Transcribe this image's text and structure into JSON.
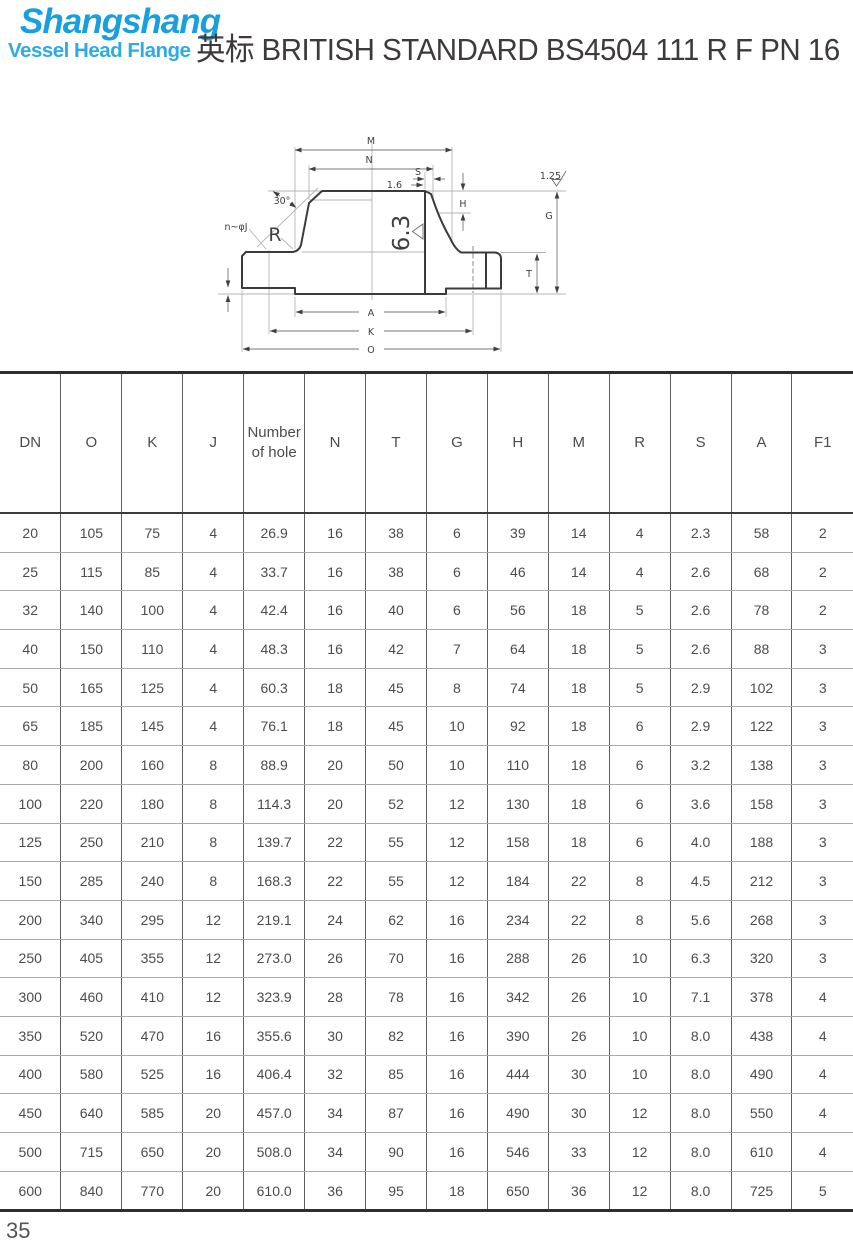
{
  "header": {
    "logo_line1": "Shangshang",
    "logo_line2": "Vessel Head Flange",
    "title_cn": "英标",
    "title_en": "BRITISH STANDARD BS4504 111 R F PN 16",
    "colors": {
      "logo_primary": "#189fe0",
      "logo_secondary": "#2fabe3",
      "title_text": "#3d3a39"
    }
  },
  "drawing": {
    "description": "Weld-neck flange cross-section with dimension callouts",
    "labels": {
      "m": "M",
      "n": "N",
      "s": "S",
      "surface_1_6": "1.6",
      "h": "H",
      "g": "G",
      "t": "T",
      "a": "A",
      "k": "K",
      "o": "O",
      "r": "R",
      "angle_30": "30°",
      "bolt_holes": "n~φJ",
      "surface_6_3": "6.3",
      "surface_1_25": "1.25"
    }
  },
  "table": {
    "columns": [
      "DN",
      "O",
      "K",
      "J",
      "Number of hole",
      "N",
      "T",
      "G",
      "H",
      "M",
      "R",
      "S",
      "A",
      "F1"
    ],
    "rows": [
      [
        "20",
        "105",
        "75",
        "4",
        "26.9",
        "16",
        "38",
        "6",
        "39",
        "14",
        "4",
        "2.3",
        "58",
        "2"
      ],
      [
        "25",
        "115",
        "85",
        "4",
        "33.7",
        "16",
        "38",
        "6",
        "46",
        "14",
        "4",
        "2.6",
        "68",
        "2"
      ],
      [
        "32",
        "140",
        "100",
        "4",
        "42.4",
        "16",
        "40",
        "6",
        "56",
        "18",
        "5",
        "2.6",
        "78",
        "2"
      ],
      [
        "40",
        "150",
        "110",
        "4",
        "48.3",
        "16",
        "42",
        "7",
        "64",
        "18",
        "5",
        "2.6",
        "88",
        "3"
      ],
      [
        "50",
        "165",
        "125",
        "4",
        "60.3",
        "18",
        "45",
        "8",
        "74",
        "18",
        "5",
        "2.9",
        "102",
        "3"
      ],
      [
        "65",
        "185",
        "145",
        "4",
        "76.1",
        "18",
        "45",
        "10",
        "92",
        "18",
        "6",
        "2.9",
        "122",
        "3"
      ],
      [
        "80",
        "200",
        "160",
        "8",
        "88.9",
        "20",
        "50",
        "10",
        "110",
        "18",
        "6",
        "3.2",
        "138",
        "3"
      ],
      [
        "100",
        "220",
        "180",
        "8",
        "114.3",
        "20",
        "52",
        "12",
        "130",
        "18",
        "6",
        "3.6",
        "158",
        "3"
      ],
      [
        "125",
        "250",
        "210",
        "8",
        "139.7",
        "22",
        "55",
        "12",
        "158",
        "18",
        "6",
        "4.0",
        "188",
        "3"
      ],
      [
        "150",
        "285",
        "240",
        "8",
        "168.3",
        "22",
        "55",
        "12",
        "184",
        "22",
        "8",
        "4.5",
        "212",
        "3"
      ],
      [
        "200",
        "340",
        "295",
        "12",
        "219.1",
        "24",
        "62",
        "16",
        "234",
        "22",
        "8",
        "5.6",
        "268",
        "3"
      ],
      [
        "250",
        "405",
        "355",
        "12",
        "273.0",
        "26",
        "70",
        "16",
        "288",
        "26",
        "10",
        "6.3",
        "320",
        "3"
      ],
      [
        "300",
        "460",
        "410",
        "12",
        "323.9",
        "28",
        "78",
        "16",
        "342",
        "26",
        "10",
        "7.1",
        "378",
        "4"
      ],
      [
        "350",
        "520",
        "470",
        "16",
        "355.6",
        "30",
        "82",
        "16",
        "390",
        "26",
        "10",
        "8.0",
        "438",
        "4"
      ],
      [
        "400",
        "580",
        "525",
        "16",
        "406.4",
        "32",
        "85",
        "16",
        "444",
        "30",
        "10",
        "8.0",
        "490",
        "4"
      ],
      [
        "450",
        "640",
        "585",
        "20",
        "457.0",
        "34",
        "87",
        "16",
        "490",
        "30",
        "12",
        "8.0",
        "550",
        "4"
      ],
      [
        "500",
        "715",
        "650",
        "20",
        "508.0",
        "34",
        "90",
        "16",
        "546",
        "33",
        "12",
        "8.0",
        "610",
        "4"
      ],
      [
        "600",
        "840",
        "770",
        "20",
        "610.0",
        "36",
        "95",
        "18",
        "650",
        "36",
        "12",
        "8.0",
        "725",
        "5"
      ]
    ]
  },
  "footer": {
    "page_number": "35"
  }
}
